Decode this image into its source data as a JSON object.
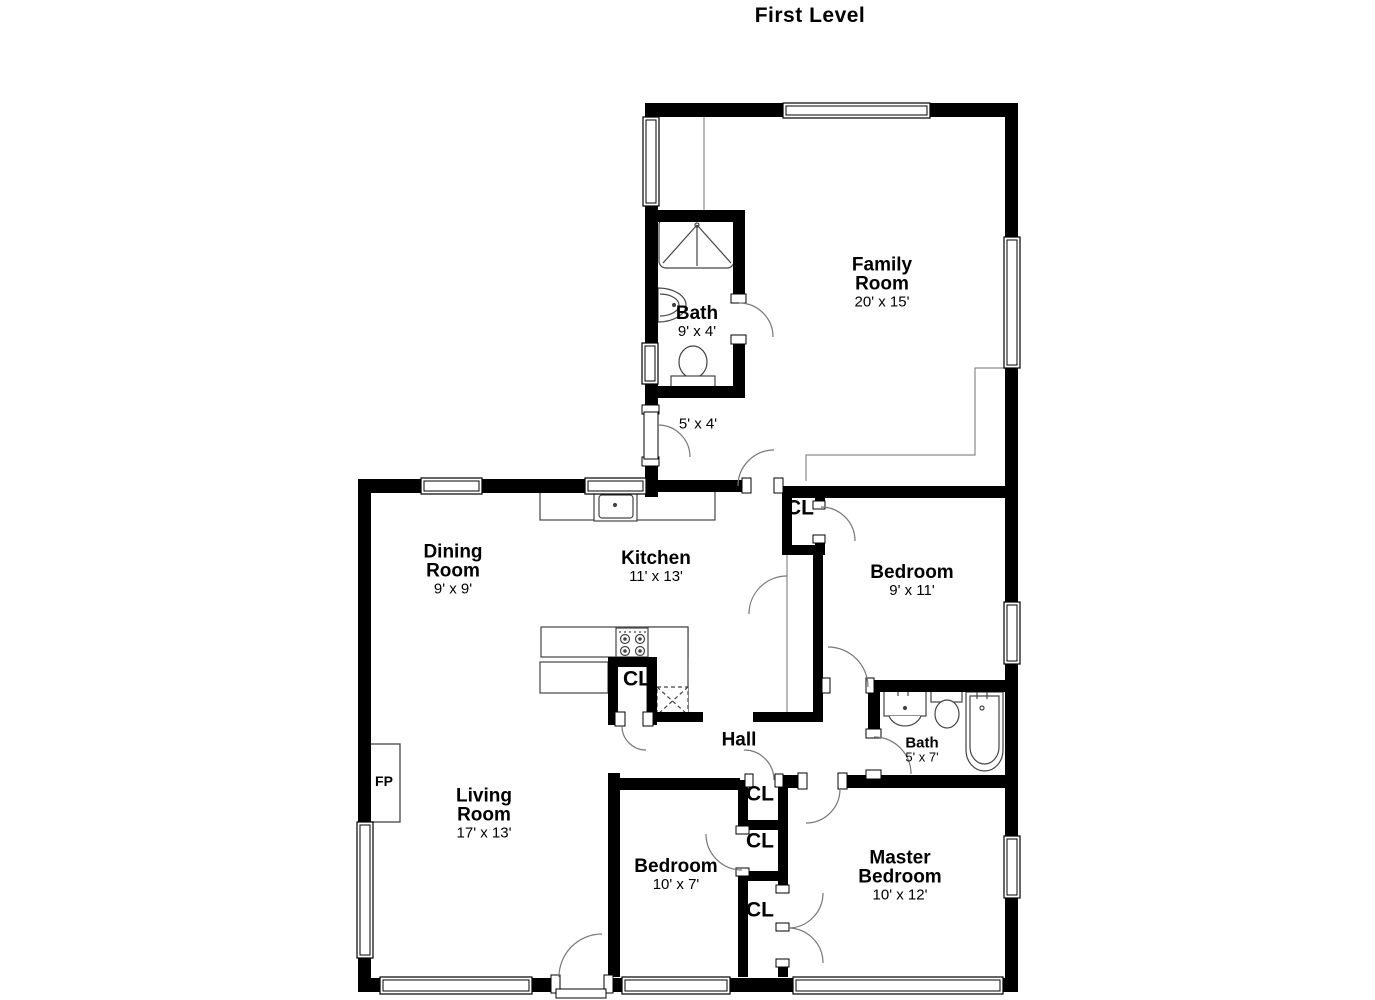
{
  "title": "First Level",
  "rooms": {
    "family": {
      "name": "Family Room",
      "dims": "20' x 15'"
    },
    "bath_upper": {
      "name": "Bath",
      "dims": "9' x 4'"
    },
    "entry": {
      "dims": "5' x 4'"
    },
    "dining": {
      "name": "Dining Room",
      "dims": "9' x 9'"
    },
    "kitchen": {
      "name": "Kitchen",
      "dims": "11' x 13'"
    },
    "bedroom1": {
      "name": "Bedroom",
      "dims": "9' x 11'"
    },
    "hall": {
      "name": "Hall"
    },
    "bath_hall": {
      "name": "Bath",
      "dims": "5' x 7'"
    },
    "living": {
      "name": "Living Room",
      "dims": "17' x 13'"
    },
    "bedroom2": {
      "name": "Bedroom",
      "dims": "10' x 7'"
    },
    "master": {
      "name": "Master Bedroom",
      "dims": "10' x 12'"
    }
  },
  "labels": {
    "closet": "CL",
    "fireplace": "FP"
  },
  "colors": {
    "wall": "#000000",
    "background": "#ffffff",
    "door_arc": "#777777",
    "fixture_line": "#444444"
  }
}
